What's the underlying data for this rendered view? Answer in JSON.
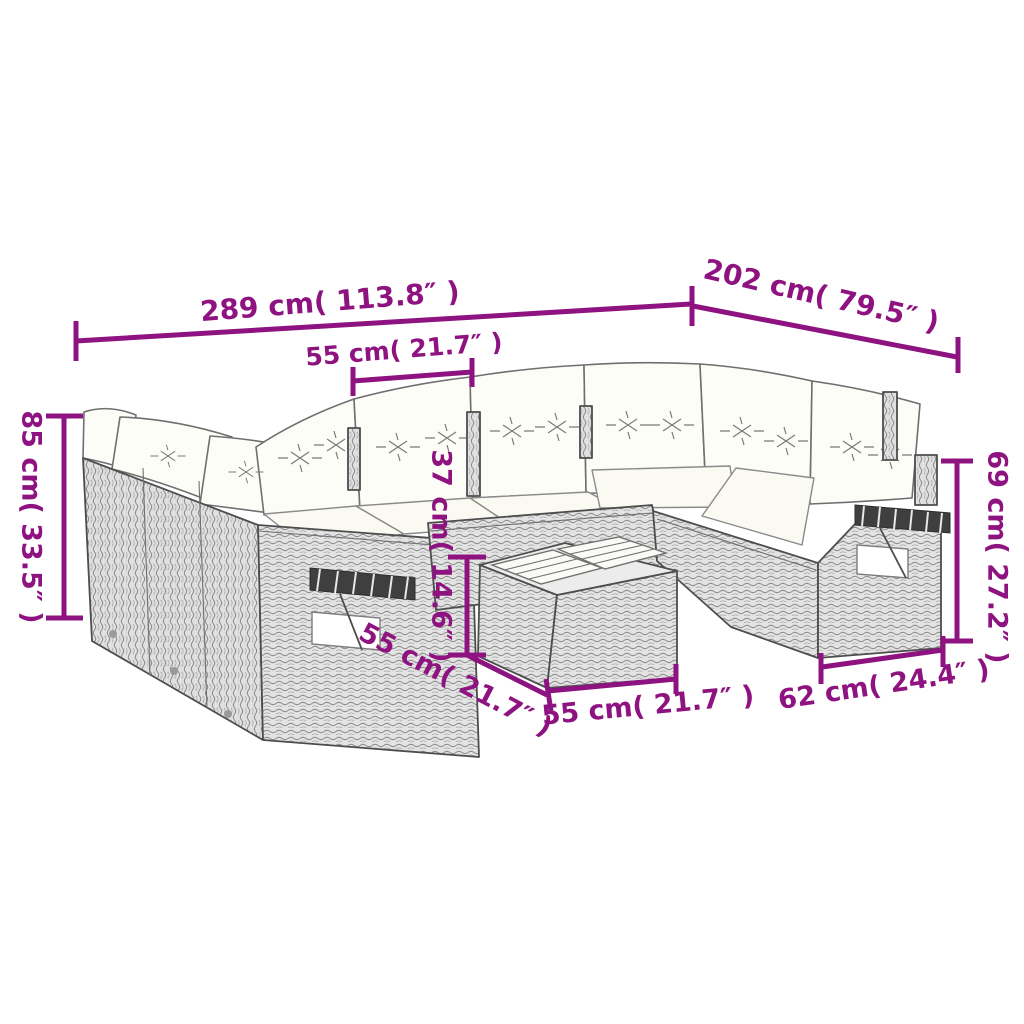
{
  "diagram": {
    "title": "rattan-garden-sofa-set-dimension-diagram",
    "accent_color": "#8E1380",
    "line_art_color": "#4d4d4d",
    "background_color": "#ffffff",
    "measurements": {
      "overall_width": {
        "label": "289 cm( 113.8″ )"
      },
      "overall_depth": {
        "label": "202 cm( 79.5″ )"
      },
      "seat_width": {
        "label": "55 cm( 21.7″ )"
      },
      "overall_height": {
        "label": "85 cm( 33.5″ )"
      },
      "table_height": {
        "label": "37 cm( 14.6″ )"
      },
      "back_height": {
        "label": "69 cm( 27.2″ )"
      },
      "table_depth": {
        "label": "55 cm( 21.7″ )"
      },
      "table_width": {
        "label": "55 cm( 21.7″ )"
      },
      "seat_depth": {
        "label": "62 cm( 24.4″ )"
      }
    }
  }
}
